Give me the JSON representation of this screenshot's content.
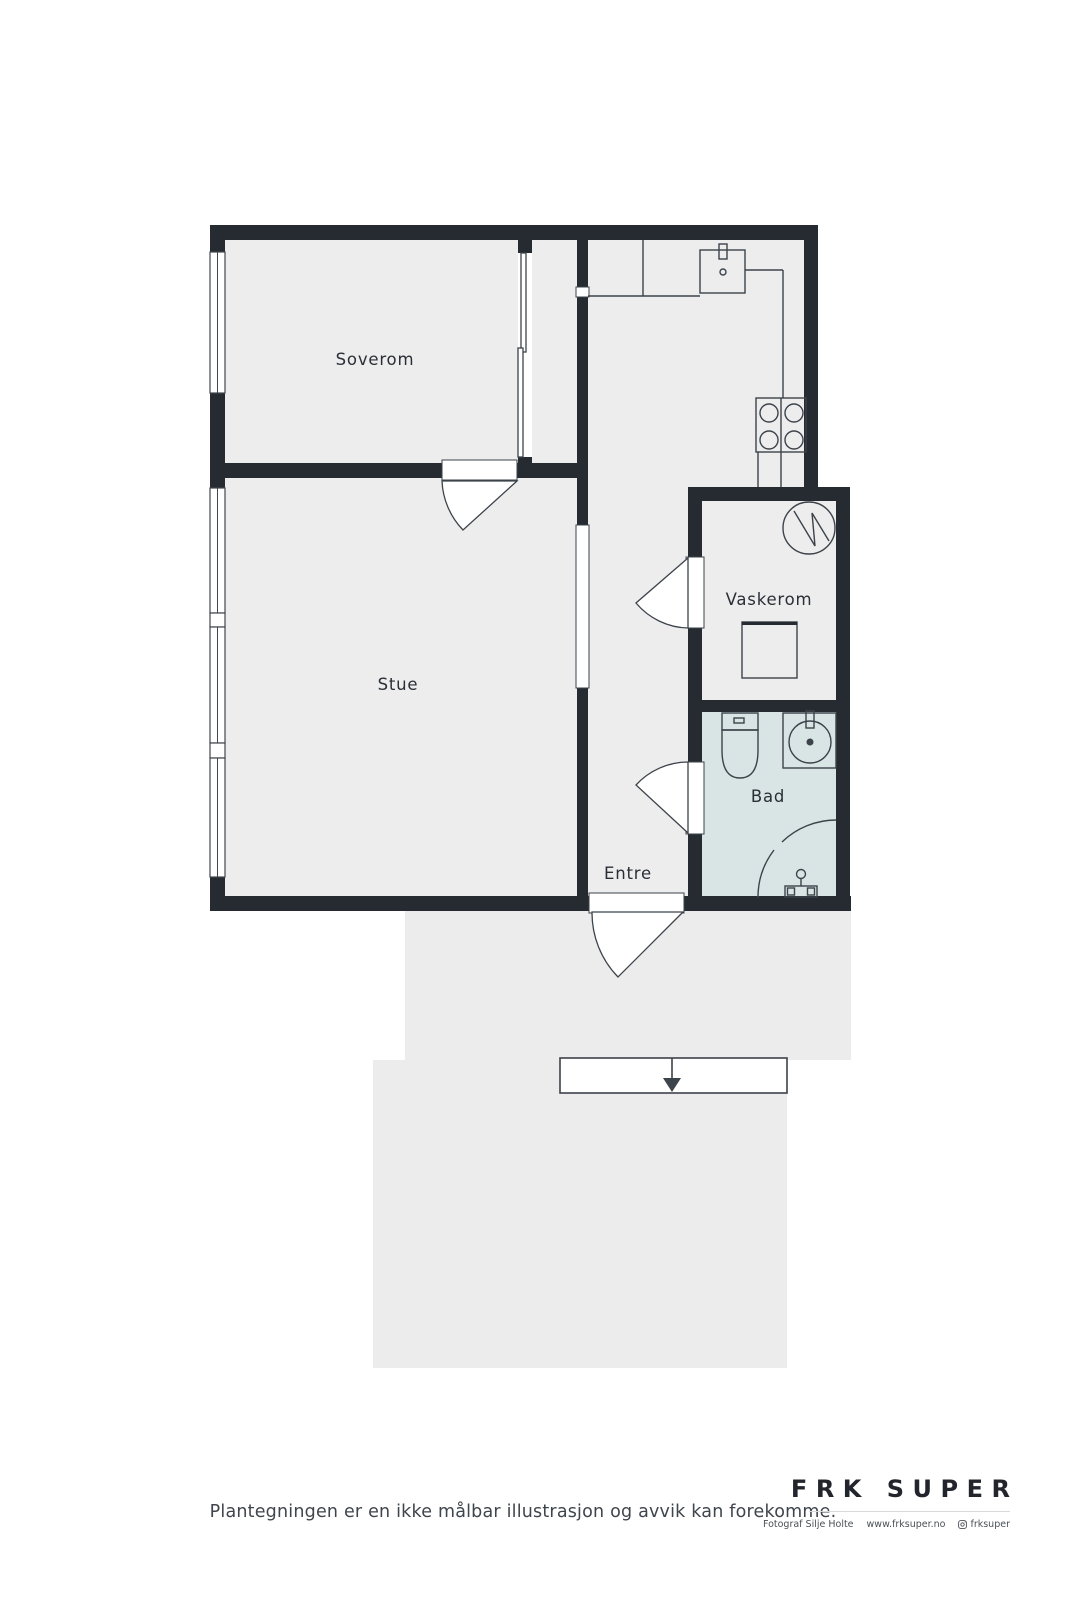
{
  "floorplan": {
    "rooms": [
      {
        "id": "soverom",
        "label": "Soverom"
      },
      {
        "id": "stue",
        "label": "Stue"
      },
      {
        "id": "vaskerom",
        "label": "Vaskerom"
      },
      {
        "id": "bad",
        "label": "Bad"
      },
      {
        "id": "entre",
        "label": "Entre"
      }
    ],
    "fixtures": [
      "kitchen-counter",
      "kitchen-sink",
      "stove-4-burner",
      "water-heater",
      "washing-machine",
      "toilet",
      "bathroom-sink",
      "corner-shower",
      "shower-mixer",
      "sliding-door",
      "entrance-arrow"
    ],
    "colors": {
      "wall": "#262b32",
      "floor": "#ededee",
      "bathroom_floor": "#d9e4e5",
      "exterior_area": "#ececed",
      "fixture_outline": "#3c434a",
      "background": "#ffffff"
    }
  },
  "footer": {
    "disclaimer": "Plantegningen er en ikke målbar illustrasjon og avvik kan forekomme."
  },
  "branding": {
    "logo": "FRK SUPER",
    "credits": {
      "photographer": "Fotograf Silje Holte",
      "website": "www.frksuper.no",
      "instagram": "frksuper"
    }
  }
}
